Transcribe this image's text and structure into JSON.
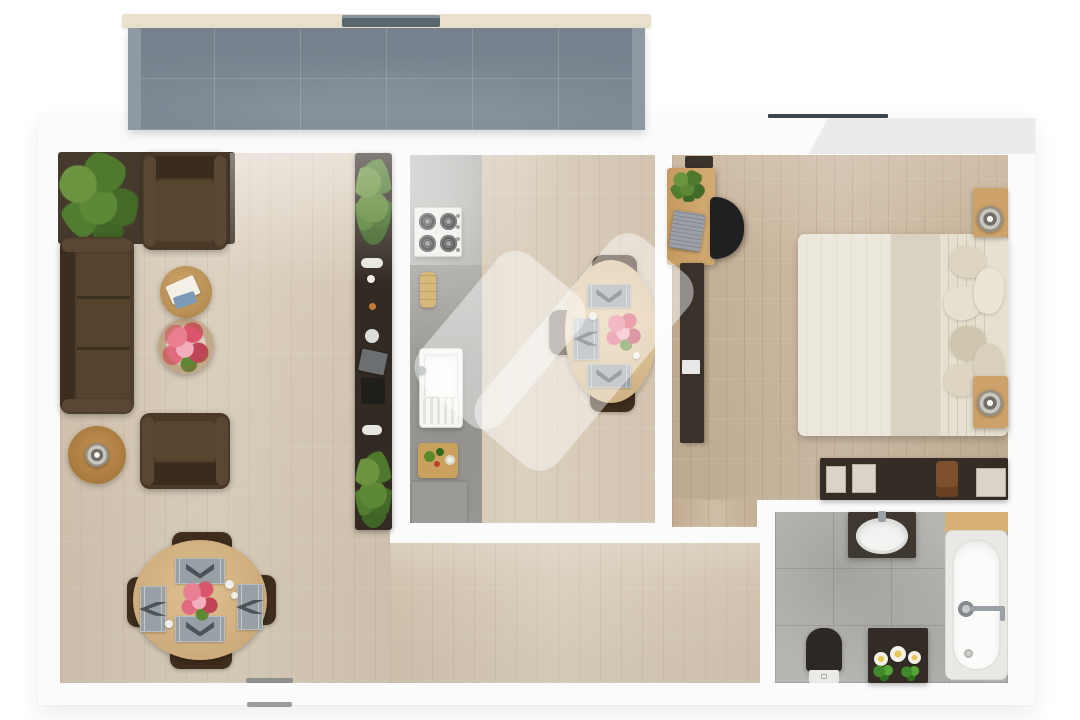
{
  "scene": {
    "description": "3D top-down floor plan rendering of a one-bedroom apartment with balcony, living-dining room, kitchen, bedroom and bathroom; large semi-transparent white logo watermark over the kitchen area",
    "background_color": "#ffffff",
    "watermark": {
      "color": "rgba(255,255,255,0.45)",
      "strokes": 2
    }
  },
  "palette": {
    "wall": "#fbfbfb",
    "living_floor": "#d7cab7",
    "bedroom_floor": "#c9b59c",
    "kitchen_concrete": "#a6a4a0",
    "bathroom_tile": "#b7b6b3",
    "balcony_tile": "#75828d",
    "balcony_rail": "#e9e1cb",
    "dark_furniture": "#332b23",
    "sofa_brown": "#4e3d2b",
    "table_wood": "#d9ba8c",
    "bed_linen": "#e9e4d8",
    "plant_green": "#5d8836",
    "flower_pink": "#e87f93",
    "window_frame": "#3d464e"
  },
  "rooms": {
    "balcony": {
      "name": "balcony",
      "items": [
        "tiled floor",
        "railing",
        "railing gate"
      ]
    },
    "living_dining": {
      "name": "living-dining room",
      "items": [
        "palm plant",
        "dark rug",
        "sofa",
        "armchair top",
        "armchair bottom",
        "side table with books",
        "side table with flowers",
        "rattan drum table with lamp",
        "oval dining table",
        "4 dining chairs",
        "4 placemats",
        "flower centerpiece",
        "bar counter with plants and dishes"
      ]
    },
    "kitchen": {
      "name": "kitchen",
      "items": [
        "gas hob",
        "bread board",
        "sink with drainer",
        "serving board with vegetables",
        "base cabinet",
        "oval breakfast table",
        "3 chairs",
        "3 placemats",
        "flower vase"
      ]
    },
    "bedroom": {
      "name": "bedroom",
      "items": [
        "desk",
        "desk plant",
        "laptop",
        "office chair",
        "wall shelf strip",
        "double bed",
        "pillows",
        "headboard",
        "2 nightstands",
        "2 bedside lamps",
        "sideboard with trays and bag"
      ]
    },
    "bathroom": {
      "name": "bathroom",
      "items": [
        "vanity with washbasin",
        "bathtub with wooden shelf",
        "wall shower mixer",
        "toilet",
        "storage cabinet",
        "daisy flowers"
      ]
    },
    "entrance": {
      "name": "entrance",
      "items": [
        "door threshold"
      ]
    }
  }
}
